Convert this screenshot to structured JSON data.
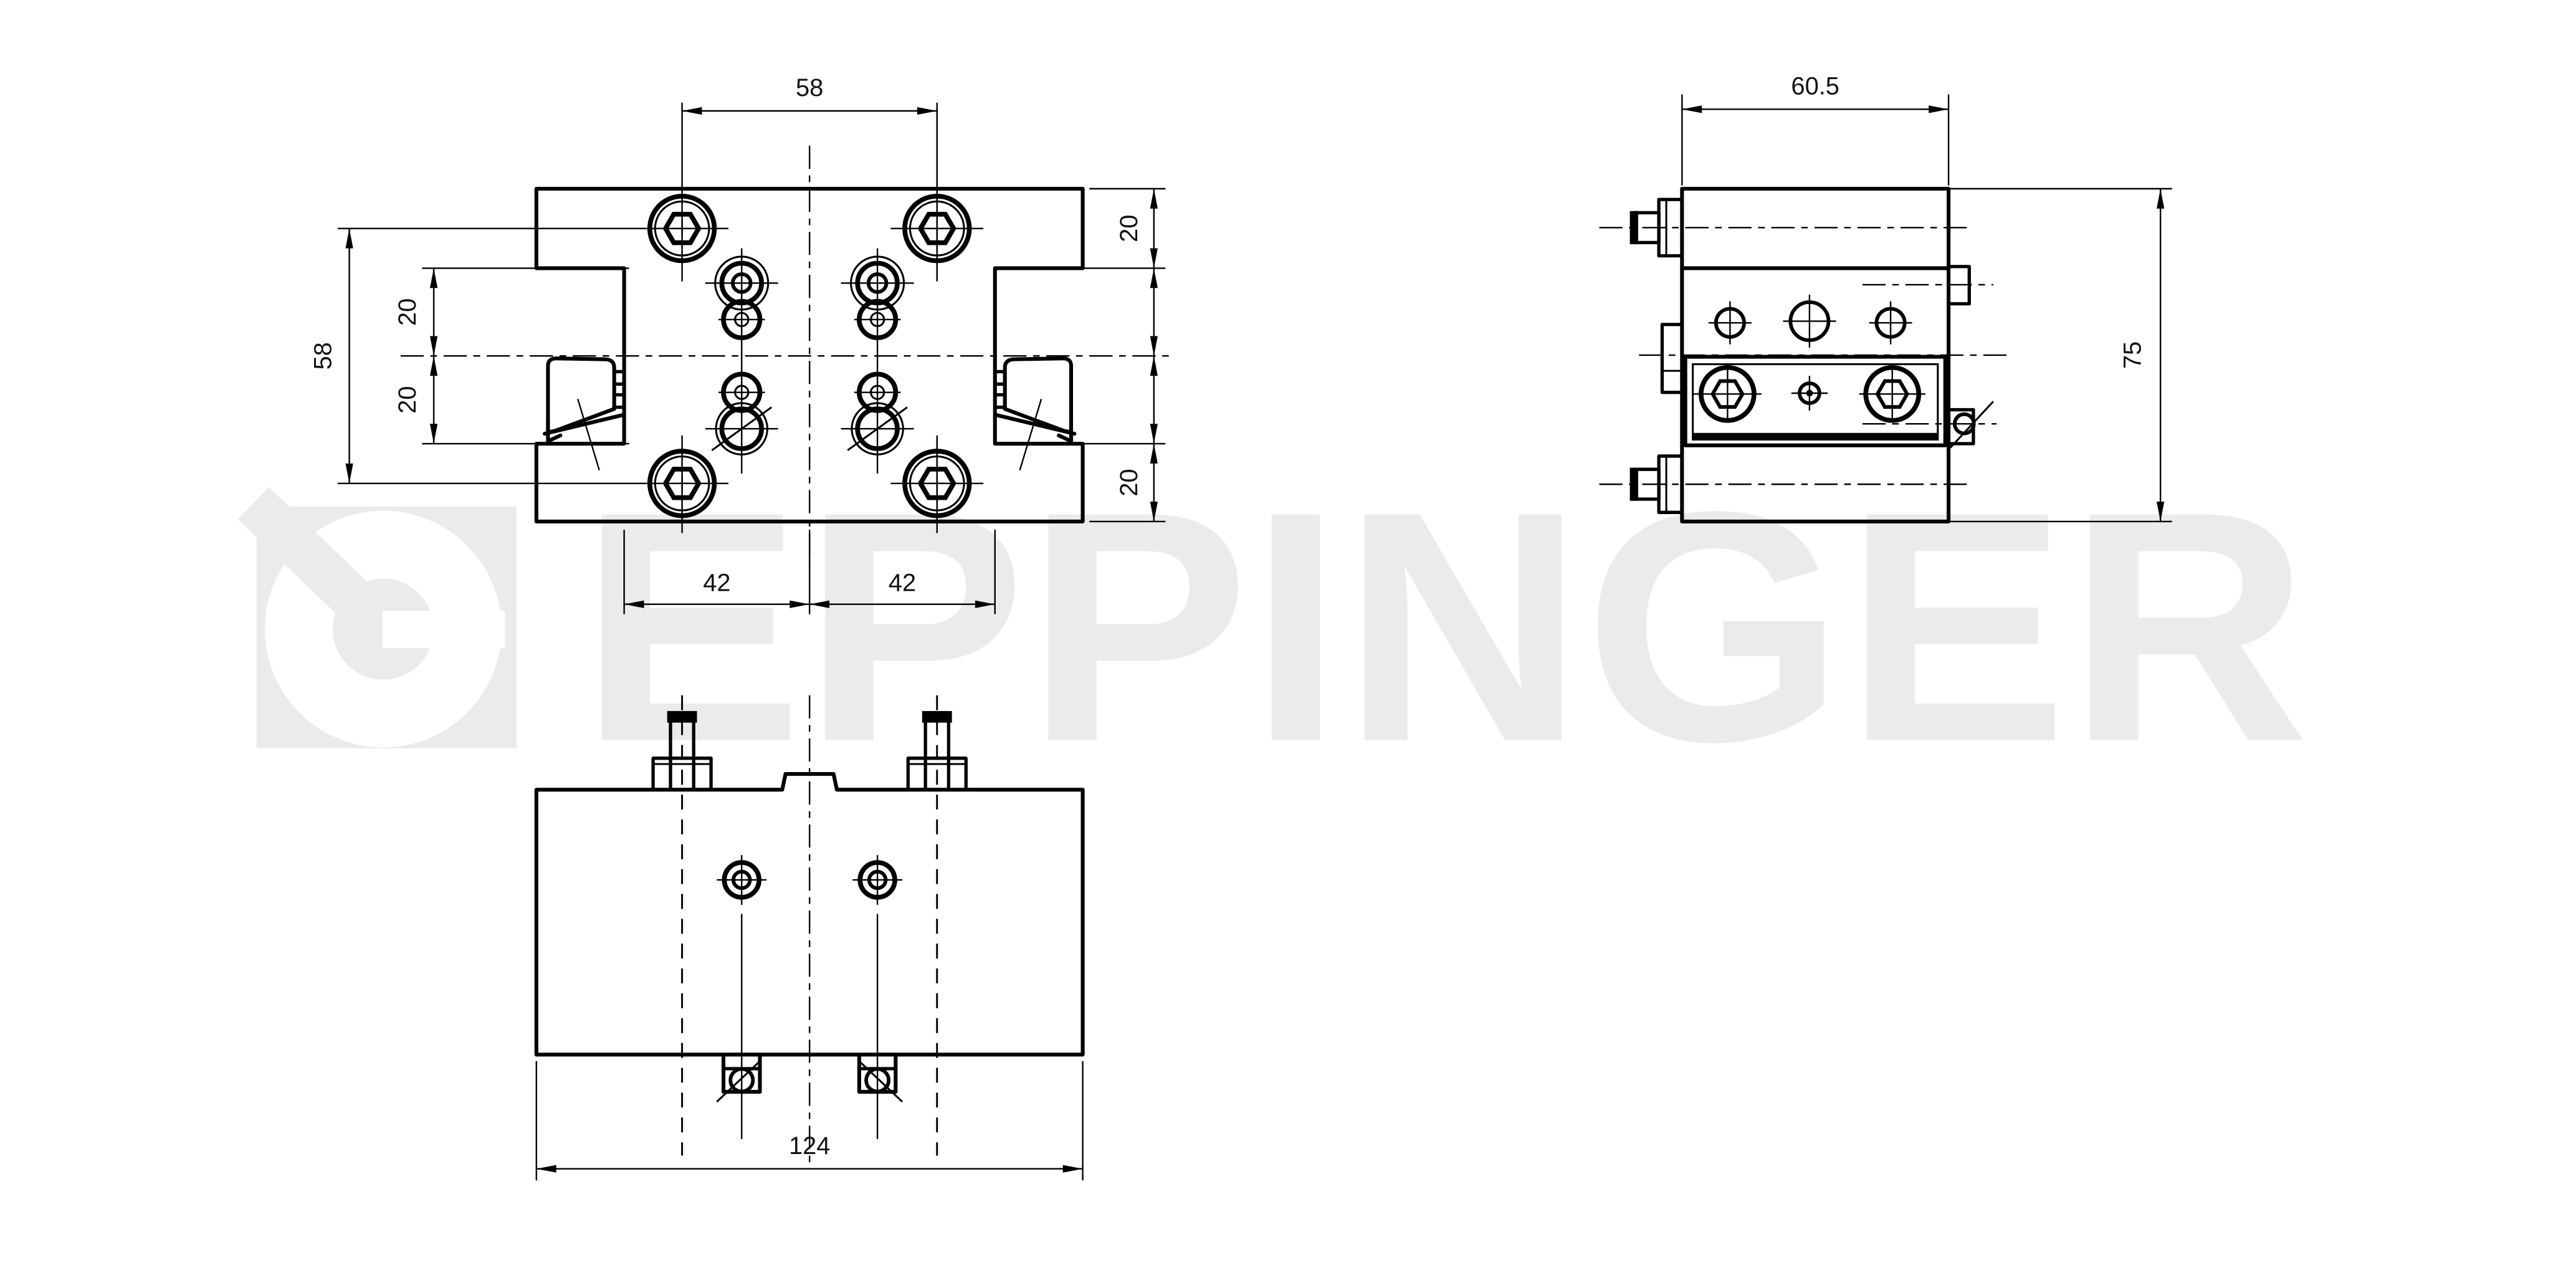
{
  "watermark": {
    "text": "EPPINGER",
    "color": "#ebebeb",
    "logo_white": "#ffffff"
  },
  "dims": {
    "top_width": "58",
    "left_height": "58",
    "left_upper": "20",
    "left_lower": "20",
    "right_upper": "20",
    "right_lower": "20",
    "slot_left": "42",
    "slot_right": "42",
    "front_width": "124",
    "side_width": "60.5",
    "side_height": "75"
  },
  "colors": {
    "line": "#000000",
    "background": "#ffffff"
  }
}
